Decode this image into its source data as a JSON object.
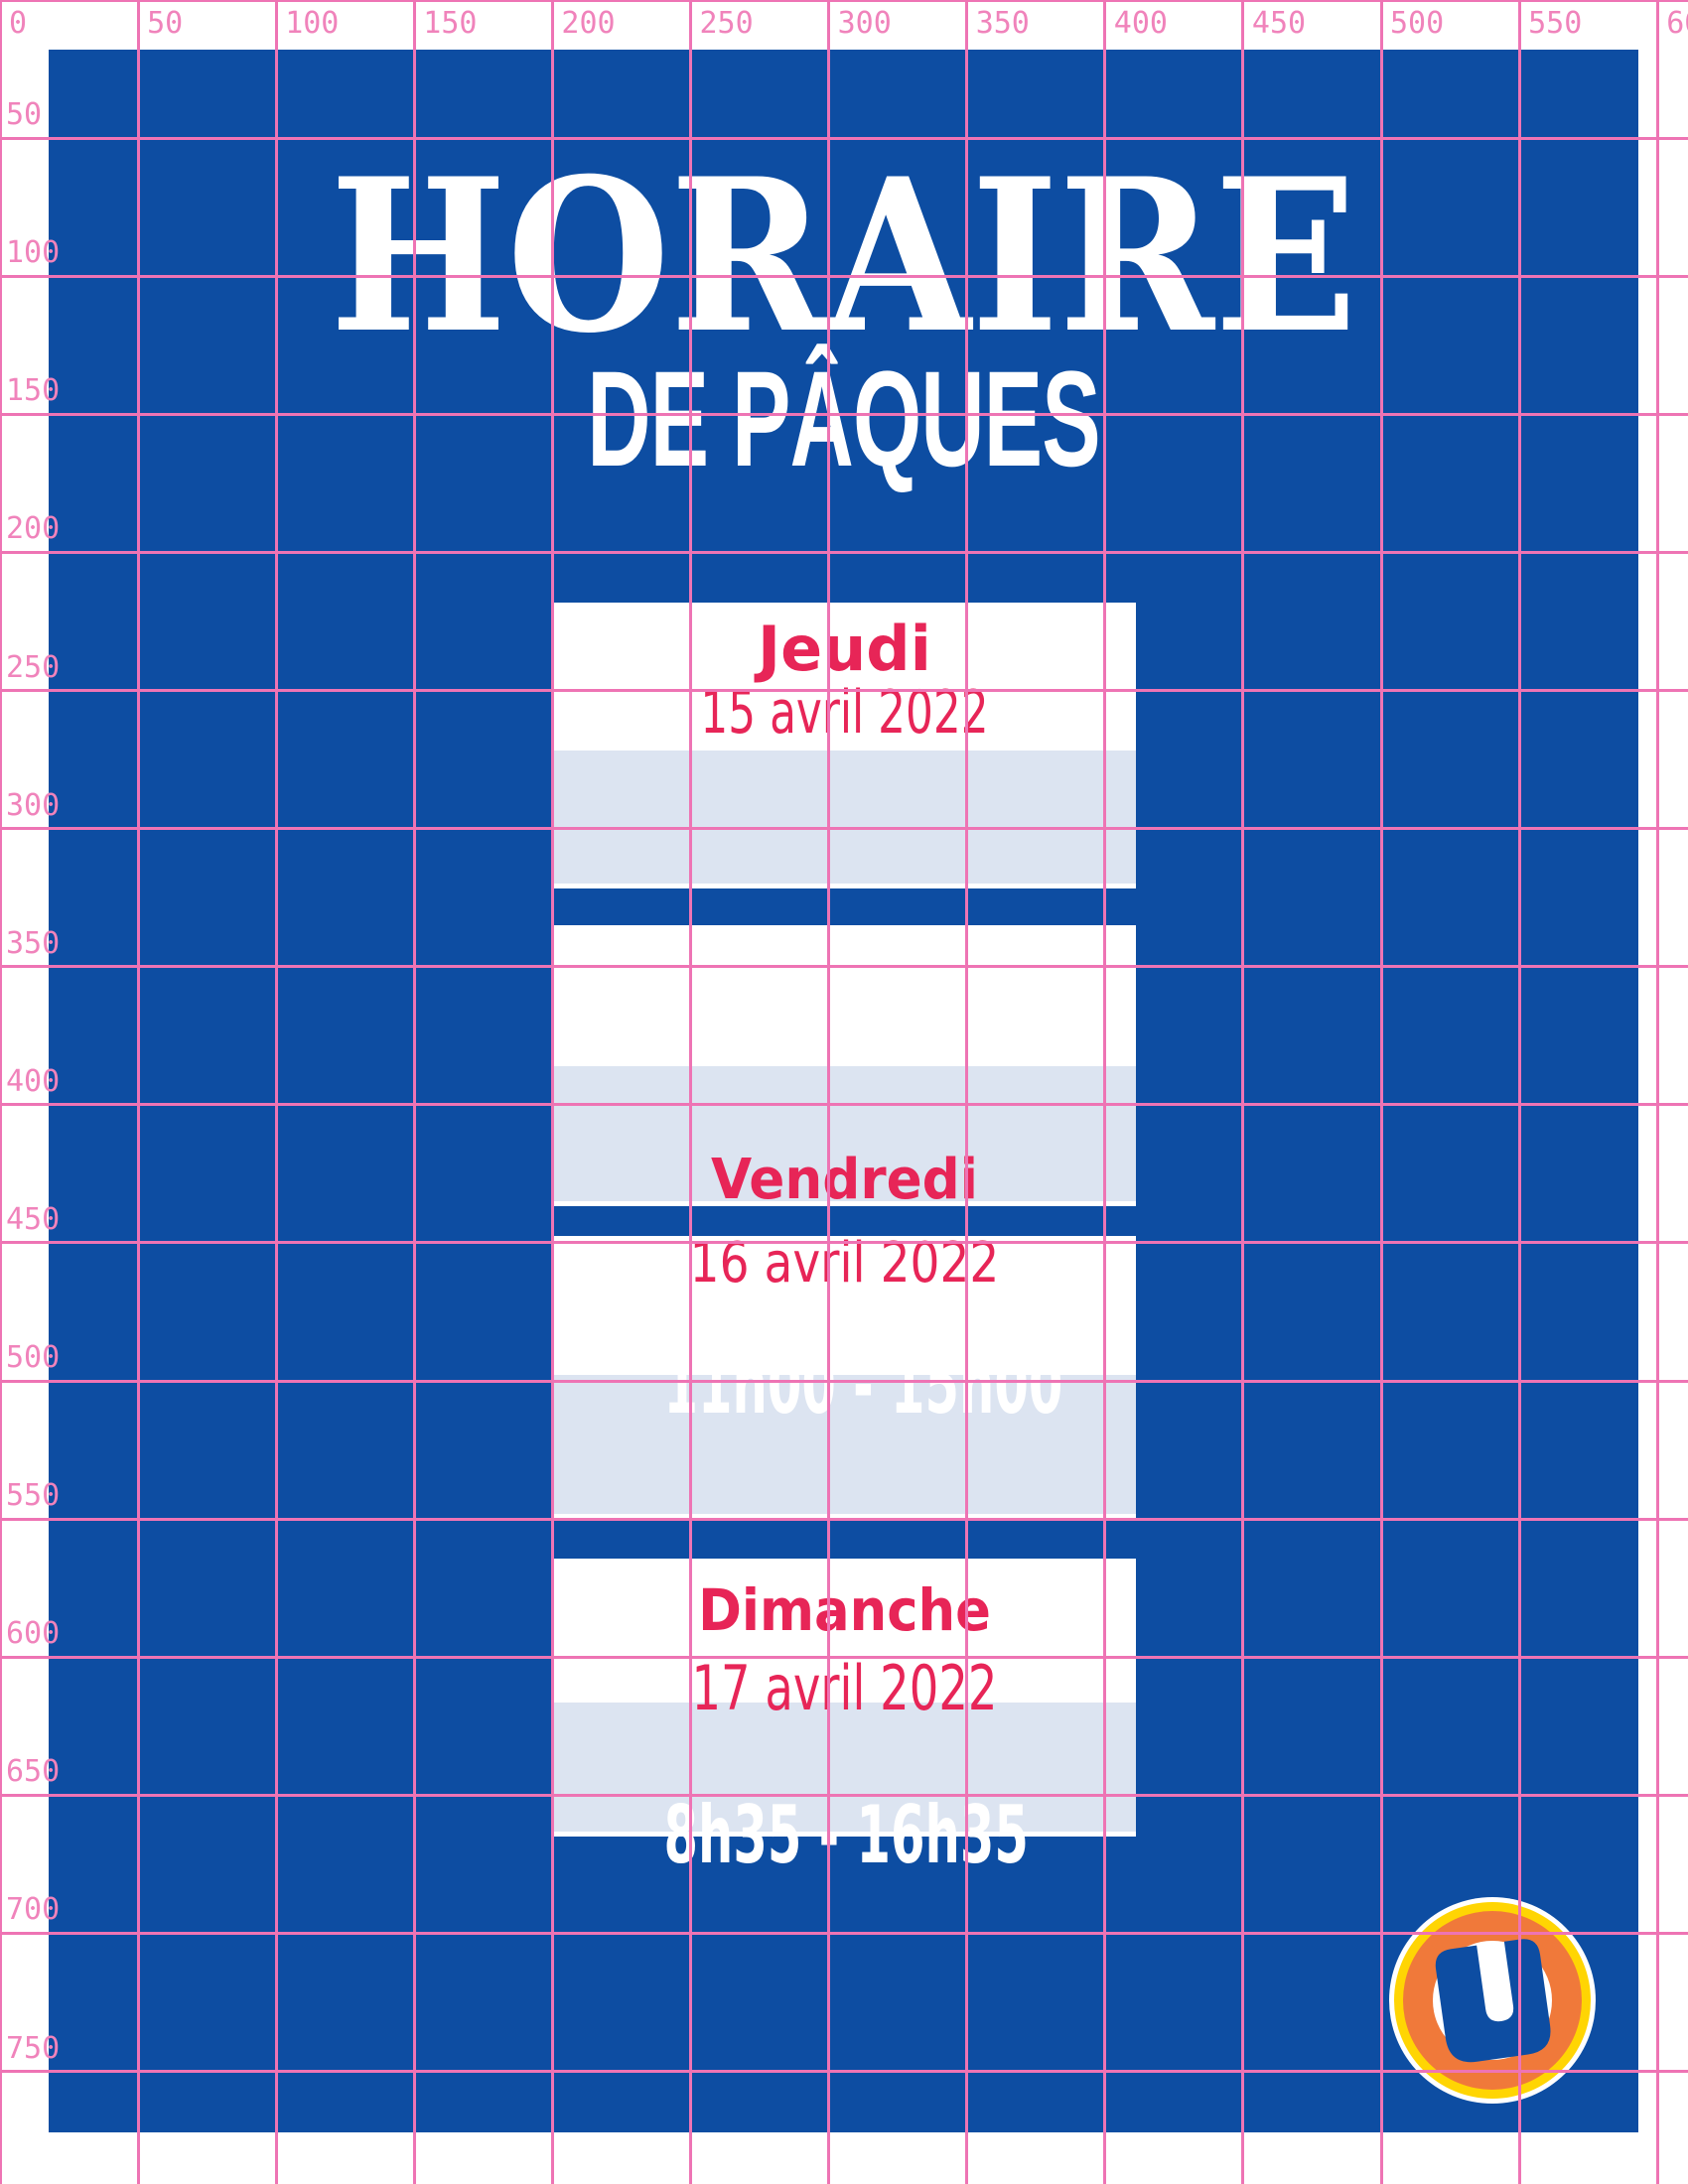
{
  "title": {
    "line1": "HORAIRE",
    "line2": "DE PÂQUES"
  },
  "cards": [
    {
      "day": "Jeudi",
      "date": "15 avril 2022"
    },
    {
      "day": "Vendredi"
    },
    {
      "date": "16 avril 2022",
      "hours": "11h00 - 15h00"
    },
    {
      "day": "Dimanche",
      "date": "17 avril 2022",
      "hours": "8h35 - 16h35"
    }
  ],
  "ruler": {
    "top": [
      "0",
      "50",
      "100",
      "150",
      "200",
      "250",
      "300",
      "350",
      "400",
      "450",
      "500",
      "550",
      "600"
    ],
    "left": [
      "50",
      "100",
      "150",
      "200",
      "250",
      "300",
      "350",
      "400",
      "450",
      "500",
      "550",
      "600",
      "650",
      "700",
      "750"
    ]
  },
  "logo": {
    "letter": "U"
  },
  "colors": {
    "blue": "#0d4da2",
    "lavender": "#dce4f1",
    "red": "#e72557",
    "grid_pink": "#ee74b4",
    "label_pink": "#f083bb",
    "logo_yellow": "#ffd503",
    "logo_orange": "#f0793a",
    "white": "#ffffff"
  }
}
